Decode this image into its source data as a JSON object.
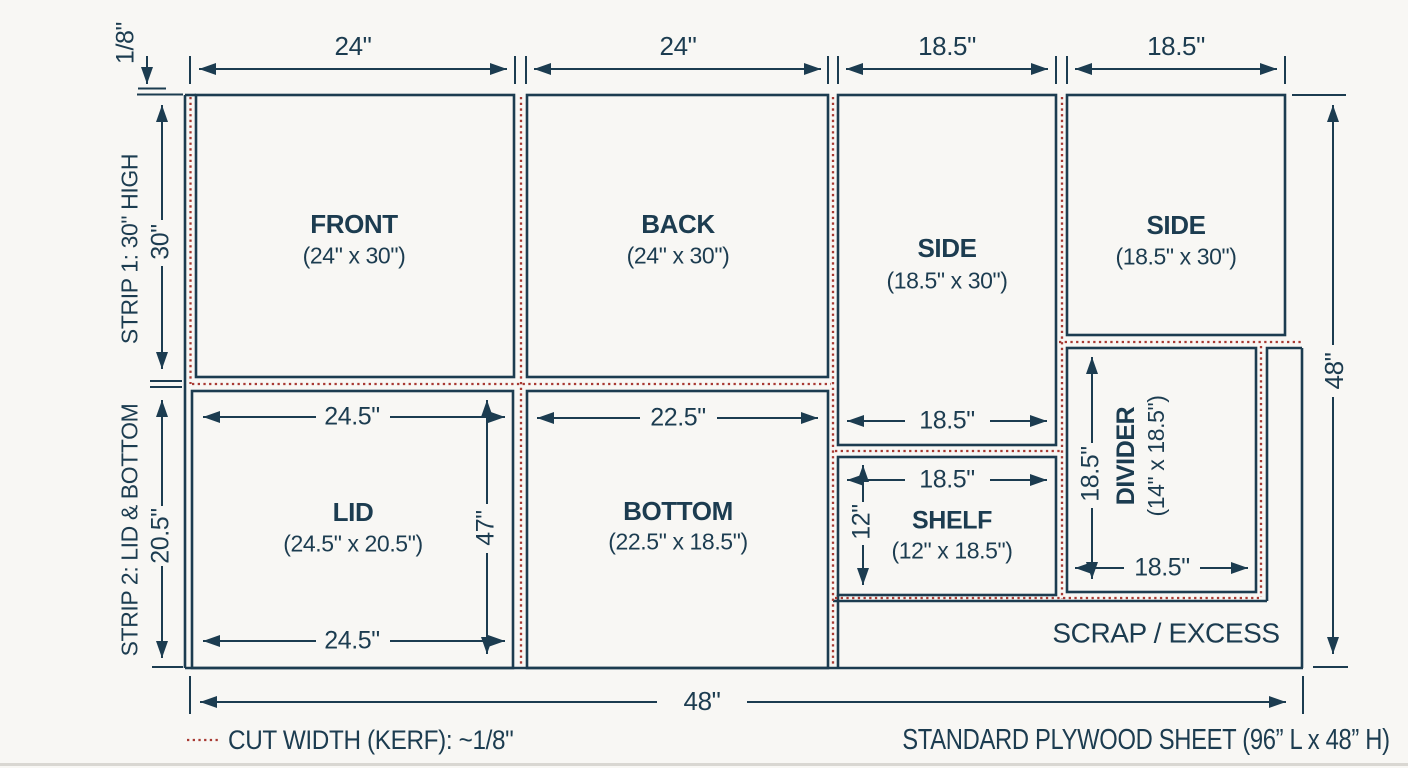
{
  "colors": {
    "line_navy": "#1c3c50",
    "kerf_red": "#a83a33",
    "background": "#f8f7f4"
  },
  "top_dimensions": {
    "front_w": "24\"",
    "back_w": "24\"",
    "side1_w": "18.5\"",
    "side2_w": "18.5\""
  },
  "left_annotations": {
    "kerf_callout": "1/8\"",
    "strip1_label": "STRIP 1: 30\" HIGH",
    "strip1_height": "30\"",
    "strip2_label": "STRIP 2: LID & BOTTOM",
    "strip2_height": "20.5\""
  },
  "panels": {
    "front": {
      "title": "FRONT",
      "size": "(24\" x 30\")"
    },
    "back": {
      "title": "BACK",
      "size": "(24\" x 30\")"
    },
    "side1": {
      "title": "SIDE",
      "size": "(18.5\" x 30\")"
    },
    "side2": {
      "title": "SIDE",
      "size": "(18.5\" x 30\")"
    },
    "lid": {
      "title": "LID",
      "size": "(24.5\" x 20.5\")"
    },
    "bottom": {
      "title": "BOTTOM",
      "size": "(22.5\" x 18.5\")"
    },
    "shelf": {
      "title": "SHELF",
      "size": "(12\" x 18.5\")"
    },
    "divider": {
      "title": "DIVIDER",
      "size": "(14\" x 18.5\")"
    },
    "scrap": {
      "title": "SCRAP / EXCESS"
    }
  },
  "inner_dimensions": {
    "lid_top_w": "24.5\"",
    "lid_bottom_w": "24.5\"",
    "lid_col_h": "47\"",
    "bottom_w": "22.5\"",
    "side1_w": "18.5\"",
    "shelf_w": "18.5\"",
    "shelf_h": "12\"",
    "divider_h": "18.5\"",
    "divider_w": "18.5\""
  },
  "overall_dimensions": {
    "sheet_bottom_w": "48\"",
    "sheet_right_h": "48\""
  },
  "legend": {
    "kerf_note": "CUT WIDTH (KERF): ~1/8\"",
    "sheet_note": "STANDARD PLYWOOD SHEET (96” L x 48” H)"
  }
}
